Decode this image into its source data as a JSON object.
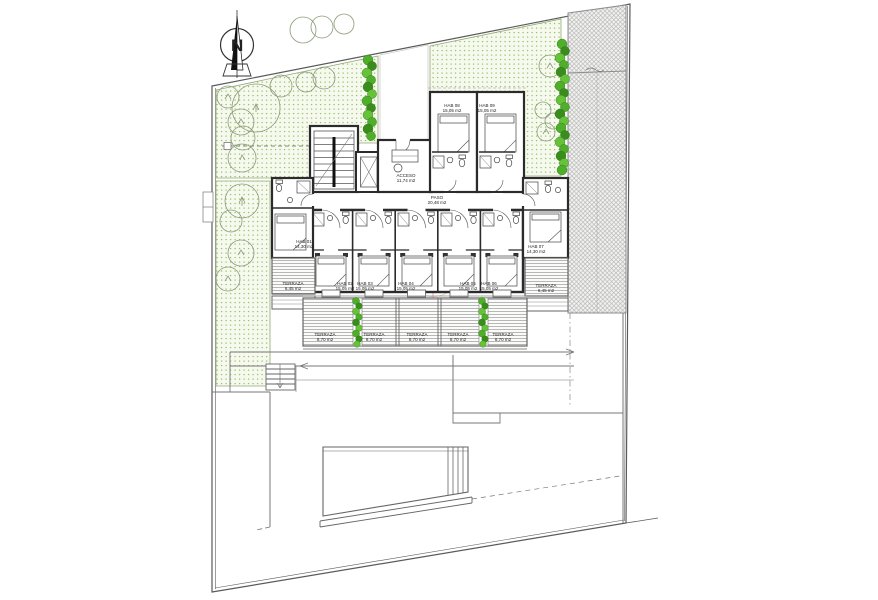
{
  "compass": {
    "label": "N"
  },
  "colors": {
    "garden_dot": "#9cbf6e",
    "hedge_green": "#4fae2a",
    "hatch_gray": "#ababab",
    "watermark_red": "#cc3b33"
  },
  "rooms": {
    "acceso": {
      "name": "ACCESO",
      "area": "11,74 m2"
    },
    "paso": {
      "name": "PASO",
      "area": "20,48 m2"
    },
    "hab01": {
      "name": "HAB 01",
      "area": "14,30 m2"
    },
    "hab02": {
      "name": "HAB 02",
      "area": "15,05 m2"
    },
    "hab03": {
      "name": "HAB 03",
      "area": "15,05 m2"
    },
    "hab04": {
      "name": "HAB 04",
      "area": "15,05 m2"
    },
    "hab05": {
      "name": "HAB 05",
      "area": "15,05 m2"
    },
    "hab06": {
      "name": "HAB 06",
      "area": "15,05 m2"
    },
    "hab07": {
      "name": "HAB 07",
      "area": "14,30 m2"
    },
    "hab08": {
      "name": "HAB 08",
      "area": "15,05 m2"
    },
    "hab09": {
      "name": "HAB 09",
      "area": "15,05 m2"
    }
  },
  "terraces": {
    "left": {
      "name": "TERRAZA",
      "area": "6,45 m2"
    },
    "right": {
      "name": "TERRAZA",
      "area": "6,45 m2"
    },
    "row": [
      {
        "name": "TERRAZA",
        "area": "8,70 m2"
      },
      {
        "name": "TERRAZA",
        "area": "8,70 m2"
      },
      {
        "name": "TERRAZA",
        "area": "8,70 m2"
      },
      {
        "name": "TERRAZA",
        "area": "8,70 m2"
      },
      {
        "name": "TERRAZA",
        "area": "8,70 m2"
      }
    ]
  },
  "watermark": {
    "text": "habitaclia"
  }
}
